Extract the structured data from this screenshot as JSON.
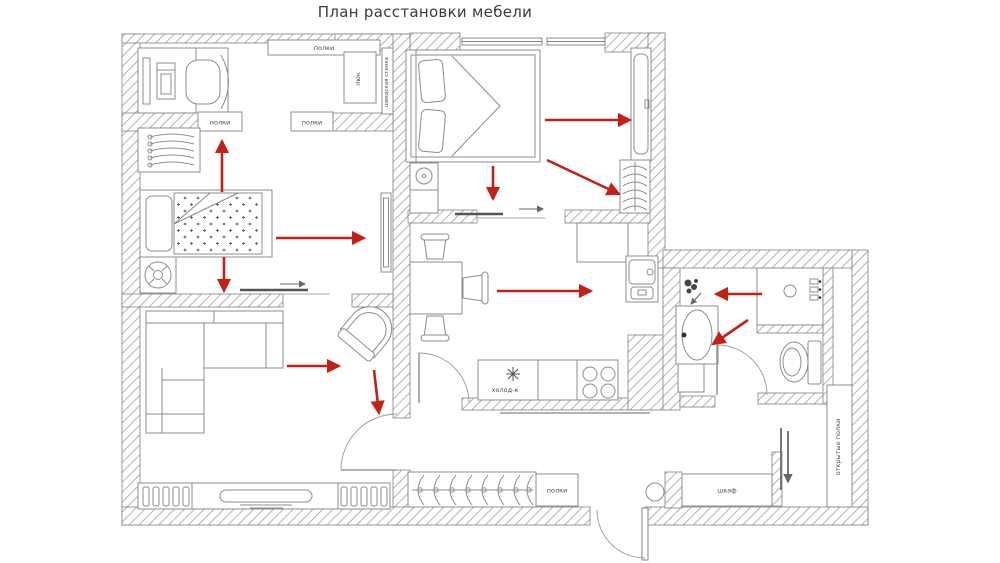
{
  "title": "План расстановки мебели",
  "colors": {
    "arrow_red": "#c32018",
    "wall_hatch": "#9a9a9a",
    "furniture_stroke": "#8c8c8c",
    "label_text": "#4a4a4a"
  },
  "rooms": {
    "children_room": {
      "shelves_top": "полки",
      "shelves_box_left": "полки",
      "shelves_box_right": "полки",
      "hatch_label": "люк",
      "wall_bars_label": "шведская стенка"
    },
    "kitchen": {
      "fridge_label": "холод-к"
    },
    "hallway": {
      "shelves_label": "полки",
      "wardrobe_label": "шкаф",
      "open_shelves_label": "открытые полки"
    }
  }
}
